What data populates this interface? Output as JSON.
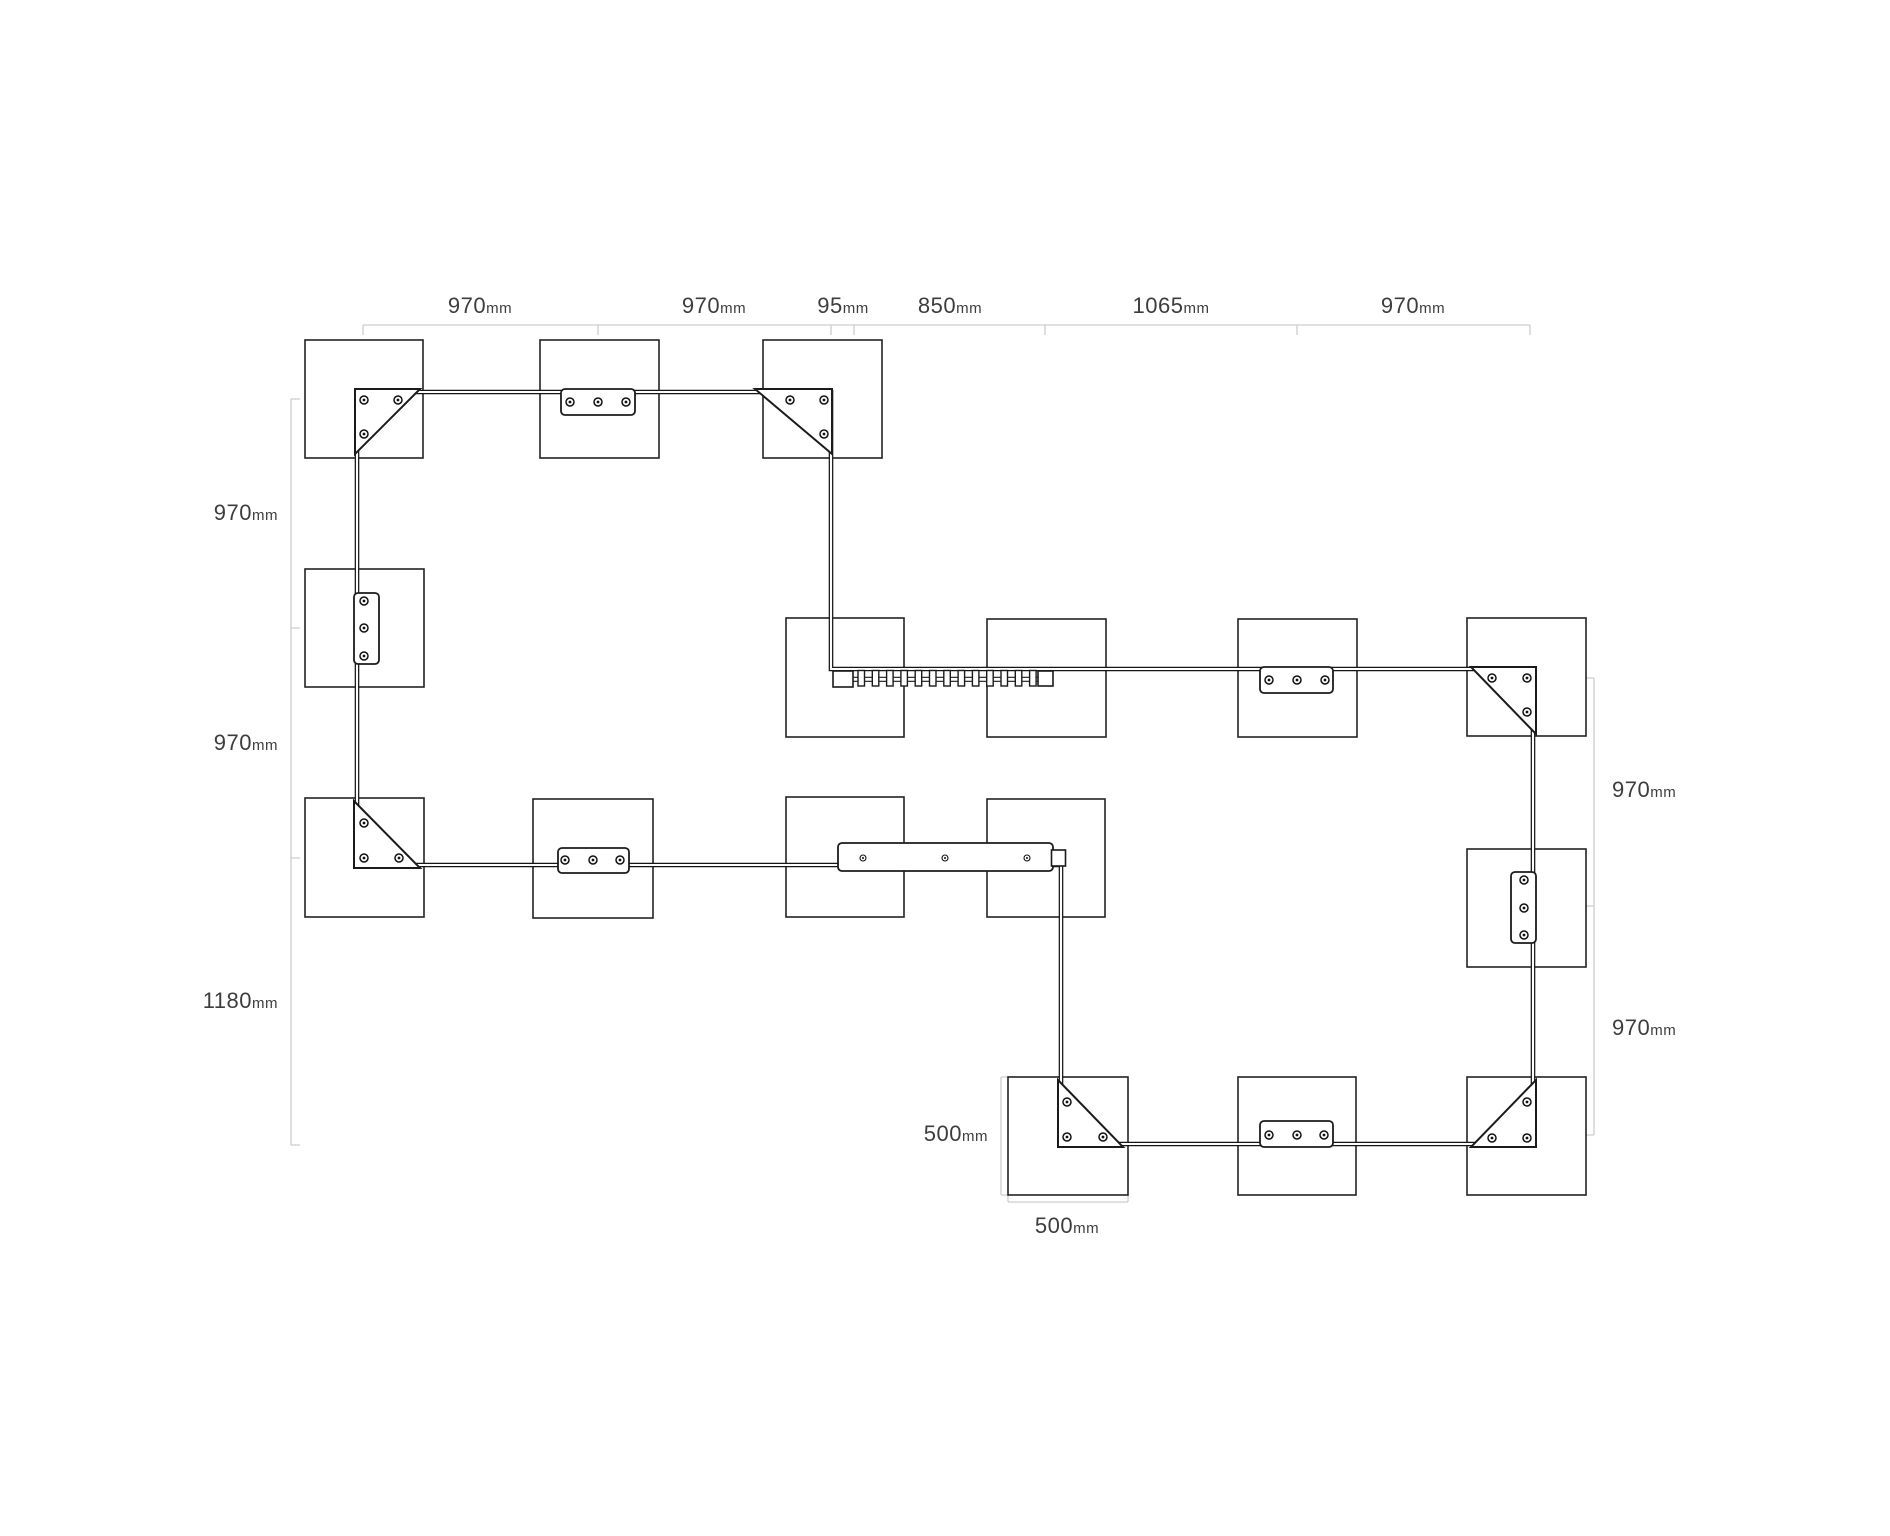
{
  "diagram": {
    "kind": "assembly-dimension-plan",
    "dims": {
      "top": [
        {
          "value": "970",
          "unit": "mm"
        },
        {
          "value": "970",
          "unit": "mm"
        },
        {
          "value": "95",
          "unit": "mm"
        },
        {
          "value": "850",
          "unit": "mm"
        },
        {
          "value": "1065",
          "unit": "mm"
        },
        {
          "value": "970",
          "unit": "mm"
        }
      ],
      "left": [
        {
          "value": "970",
          "unit": "mm"
        },
        {
          "value": "970",
          "unit": "mm"
        },
        {
          "value": "1180",
          "unit": "mm"
        }
      ],
      "right": [
        {
          "value": "970",
          "unit": "mm"
        },
        {
          "value": "970",
          "unit": "mm"
        }
      ],
      "bottom": [
        {
          "value": "500",
          "unit": "mm"
        },
        {
          "value": "500",
          "unit": "mm"
        }
      ]
    }
  }
}
